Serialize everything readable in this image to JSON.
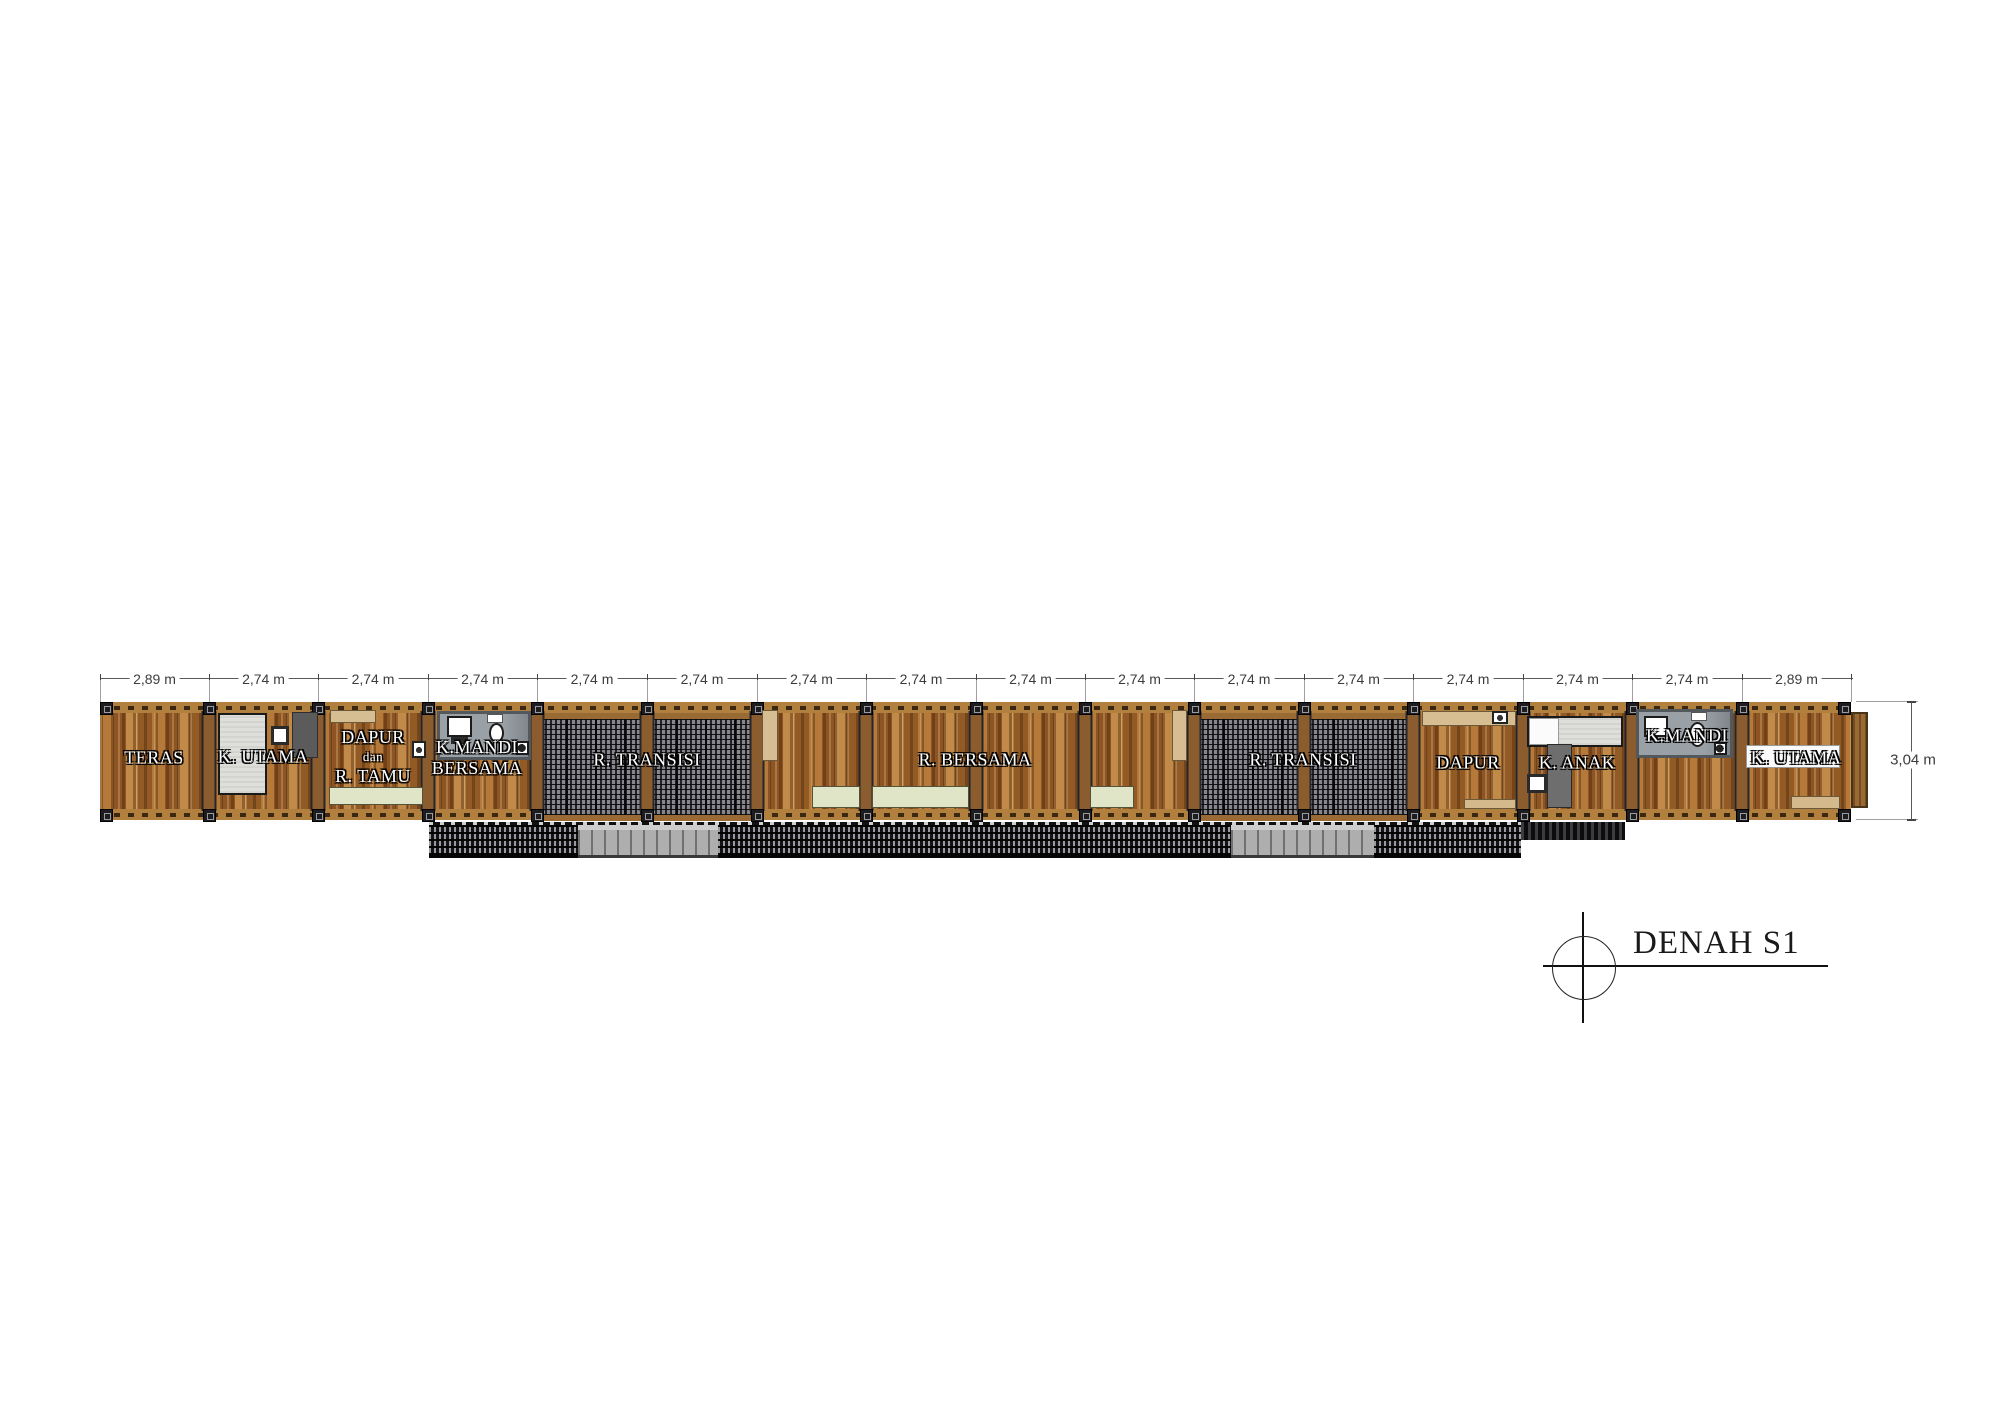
{
  "plan": {
    "title": "DENAH S1"
  },
  "dimensions": {
    "top_segments": [
      "2,89 m",
      "2,74 m",
      "2,74 m",
      "2,74 m",
      "2,74 m",
      "2,74 m",
      "2,74 m",
      "2,74 m",
      "2,74 m",
      "2,74 m",
      "2,74 m",
      "2,74 m",
      "2,74 m",
      "2,74 m",
      "2,74 m",
      "2,89 m"
    ],
    "side": "3,04 m"
  },
  "rooms": [
    {
      "id": "teras",
      "lines": [
        "TERAS"
      ]
    },
    {
      "id": "k-utama-left",
      "lines": [
        "K. UTAMA"
      ]
    },
    {
      "id": "dapur-r-tamu",
      "lines": [
        "DAPUR",
        "dan",
        "R. TAMU"
      ]
    },
    {
      "id": "k-mandi-bersama",
      "lines": [
        "K.MANDI",
        "BERSAMA"
      ]
    },
    {
      "id": "r-transisi-left",
      "lines": [
        "R. TRANSISI"
      ]
    },
    {
      "id": "r-bersama",
      "lines": [
        "R. BERSAMA"
      ]
    },
    {
      "id": "r-transisi-right",
      "lines": [
        "R. TRANSISI"
      ]
    },
    {
      "id": "dapur-right",
      "lines": [
        "DAPUR"
      ]
    },
    {
      "id": "k-anak",
      "lines": [
        "K. ANAK"
      ]
    },
    {
      "id": "k-mandi-right",
      "lines": [
        "K.MANDI"
      ]
    },
    {
      "id": "k-utama-right",
      "lines": [
        "K. UTAMA"
      ]
    }
  ],
  "colors": {
    "wood_base": "#a4682e",
    "wood_band": "#b1803f",
    "grate_dark": "#26262a",
    "deck_dark": "#1c1c1f",
    "deck_gray": "#aeaeae",
    "bath_gray": "#9aa1a6",
    "rug_green": "#e0e5c8",
    "rug_tan": "#d3b98b",
    "counter_tan": "#d6bd92",
    "bed_white": "#dedfdb",
    "bed_green": "#ccd2a8",
    "label_text": "#ffffff",
    "dimension_text": "#3c3c3c",
    "title_text": "#1a1a1a"
  }
}
